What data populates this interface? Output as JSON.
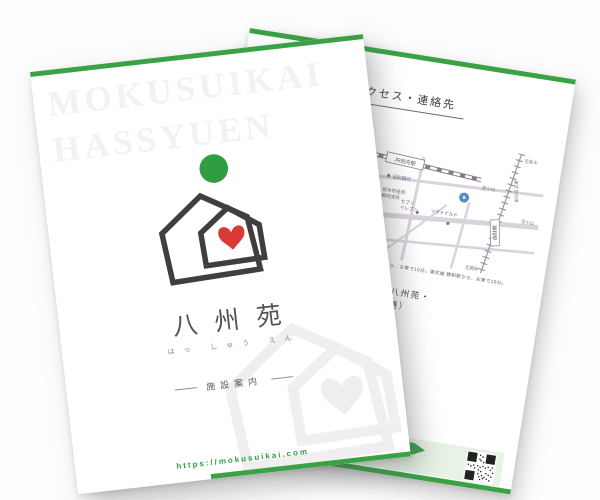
{
  "colors": {
    "accent_green": "#3aa245",
    "logo_green": "#2f9e43",
    "heart_red": "#d93a36",
    "panel_green": "#e8f3e5"
  },
  "front": {
    "watermark_line1": "MOKUSUIKAI",
    "watermark_line2": "HASSYUEN",
    "title": "八州苑",
    "furigana": "はっ しゅう えん",
    "subtitle": "施設案内",
    "url": "https://mokusuikai.com"
  },
  "back": {
    "heading": "アクセス・連絡先",
    "map": {
      "jr_station": "JR岩舟駅",
      "to_sano": "至佐野",
      "to_oyama_a": "至小山",
      "to_oyama_b": "至小山",
      "to_tochigi": "至栃木",
      "to_fujioka": "至藤岡",
      "tobu_line": "東武日光線",
      "tobu_station": "静和駅",
      "poi_bank": "足利銀行",
      "poi_cityhall_l1": "栃木市役所",
      "poi_cityhall_l2": "藤岡支所",
      "poi_conv1_l1": "セブン",
      "poi_conv1_l2": "イレブン",
      "poi_mcd": "マクドナルド",
      "poi_conv2_l1": "セブン",
      "poi_conv2_l2": "イレブン",
      "poi_postoffice": "郵便局",
      "poi_bridge": "歩道橋"
    },
    "access_note": "お車で5分。JR両毛線 岩舟駅から、お車で10分。東武線 静和駅から、お車で10分。",
    "contacts": [
      {
        "name_line1": "通所リハビリテーション 八州苑・",
        "name_line2": "デイサービス 八州苑（共通）",
        "address": "〒323-1738 栃木市藤岡町太刀 1294-1",
        "tel": "TEL 0282-61-7171　FAX 0282-61-1792"
      },
      {
        "name_line1": "小規模多機能施設 八州苑",
        "name_line2": "（支援ステーション）",
        "address": "栃木市藤岡町太刀 1294-1",
        "tel": "TEL 0282-61-0770　FAX 0282-61-1107"
      },
      {
        "name_line1": "支援センター 八州苑",
        "name_line2": "",
        "address": "栃木市藤岡町太刀 1294-1",
        "tel": "TEL／FAX 0282-62-8177"
      }
    ],
    "cta": {
      "ribbon": "スマートフォンの方はこちらから",
      "note_line1": "見学ご希望の方はお気軽に",
      "note_line2": "お問い合わせください。"
    }
  }
}
